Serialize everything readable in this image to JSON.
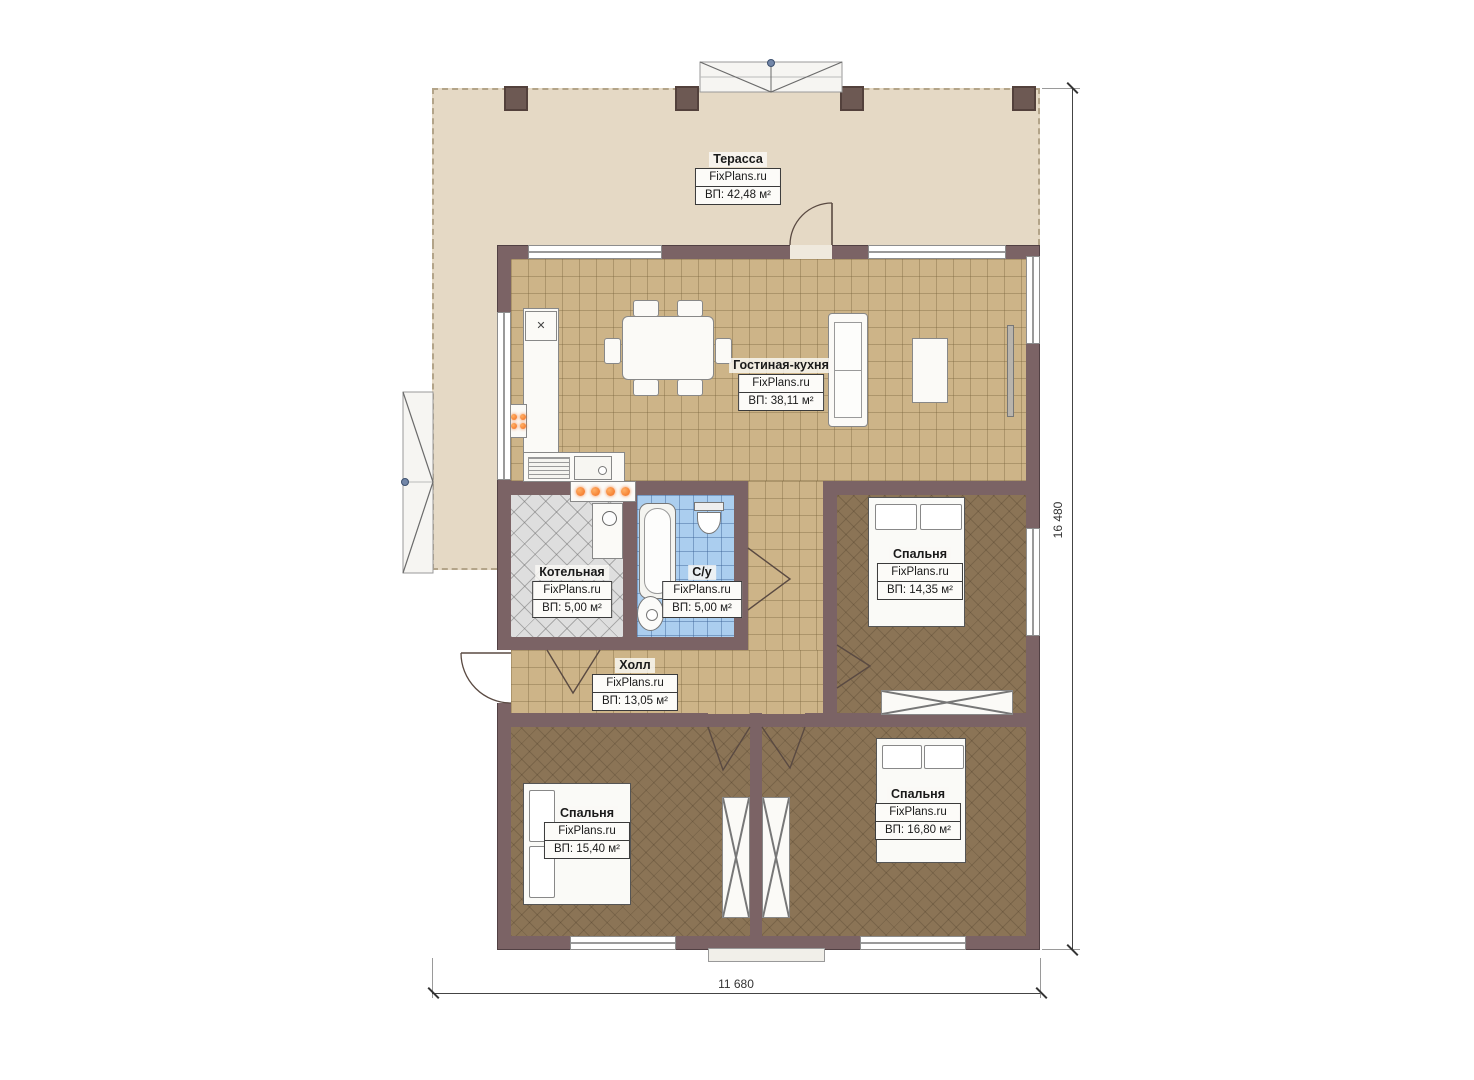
{
  "plan": {
    "dimension_right": "16 480",
    "dimension_bottom": "11 680"
  },
  "rooms": {
    "terrace": {
      "name": "Терасса",
      "brand": "FixPlans.ru",
      "area": "ВП: 42,48 м²"
    },
    "living": {
      "name": "Гостиная-кухня",
      "brand": "FixPlans.ru",
      "area": "ВП: 38,11 м²"
    },
    "boiler": {
      "name": "Котельная",
      "brand": "FixPlans.ru",
      "area": "ВП: 5,00 м²"
    },
    "wc": {
      "name": "С/у",
      "brand": "FixPlans.ru",
      "area": "ВП: 5,00 м²"
    },
    "hall": {
      "name": "Холл",
      "brand": "FixPlans.ru",
      "area": "ВП: 13,05 м²"
    },
    "bedroom_top_right": {
      "name": "Спальня",
      "brand": "FixPlans.ru",
      "area": "ВП: 14,35 м²"
    },
    "bedroom_bottom_left": {
      "name": "Спальня",
      "brand": "FixPlans.ru",
      "area": "ВП: 15,40 м²"
    },
    "bedroom_bottom_right": {
      "name": "Спальня",
      "brand": "FixPlans.ru",
      "area": "ВП: 16,80 м²"
    }
  },
  "icons": {
    "vent": "✕"
  },
  "colors": {
    "wall": "#7b6365",
    "terrace": "#e5d9c5",
    "tile_floor": "#cdb488",
    "bedroom_floor": "#8b7456",
    "boiler_floor": "#dedede",
    "bath_floor": "#abceef",
    "burner": "#f26d1d"
  }
}
